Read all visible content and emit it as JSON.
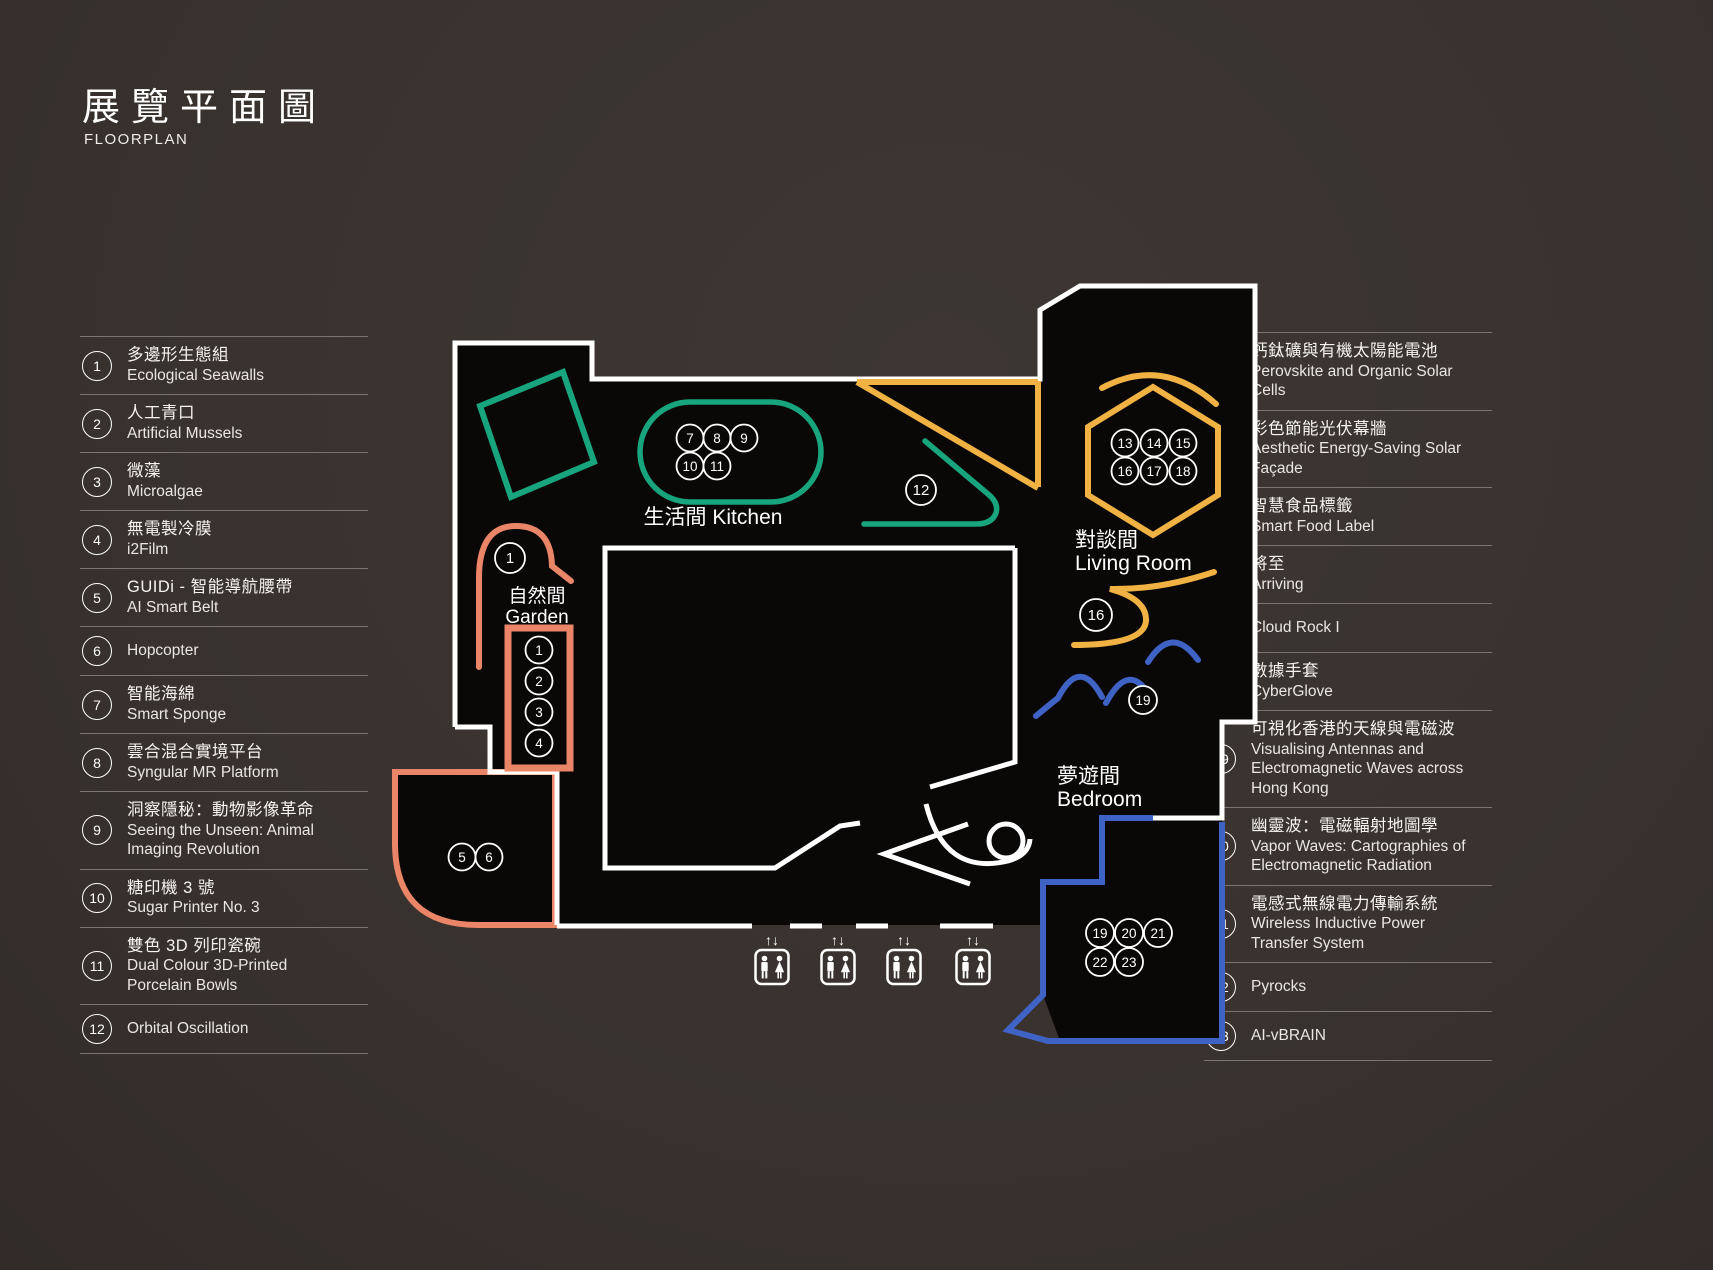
{
  "title": {
    "zh": "展覽平面圖",
    "en": "FLOORPLAN"
  },
  "legend_left": [
    {
      "num": "1",
      "zh": "多邊形生態組",
      "en": "Ecological Seawalls"
    },
    {
      "num": "2",
      "zh": "人工青口",
      "en": "Artificial Mussels"
    },
    {
      "num": "3",
      "zh": "微藻",
      "en": "Microalgae"
    },
    {
      "num": "4",
      "zh": "無電製冷膜",
      "en": "i2Film"
    },
    {
      "num": "5",
      "zh": "GUIDi - 智能導航腰帶",
      "en": "AI Smart Belt"
    },
    {
      "num": "6",
      "zh": "",
      "en": "Hopcopter"
    },
    {
      "num": "7",
      "zh": "智能海綿",
      "en": "Smart Sponge"
    },
    {
      "num": "8",
      "zh": "雲合混合實境平台",
      "en": "Syngular MR Platform"
    },
    {
      "num": "9",
      "zh": "洞察隱秘：動物影像革命",
      "en": "Seeing the Unseen: Animal Imaging Revolution"
    },
    {
      "num": "10",
      "zh": "糖印機 3 號",
      "en": "Sugar Printer No. 3"
    },
    {
      "num": "11",
      "zh": "雙色 3D 列印瓷碗",
      "en": "Dual Colour 3D-Printed Porcelain Bowls"
    },
    {
      "num": "12",
      "zh": "",
      "en": "Orbital Oscillation"
    }
  ],
  "legend_right": [
    {
      "num": "13",
      "zh": "鈣鈦礦與有機太陽能電池",
      "en": "Perovskite and Organic Solar Cells"
    },
    {
      "num": "14",
      "zh": "彩色節能光伏幕牆",
      "en": "Aesthetic Energy-Saving Solar Façade"
    },
    {
      "num": "15",
      "zh": "智慧食品標籤",
      "en": "Smart Food Label"
    },
    {
      "num": "16",
      "zh": "將至",
      "en": "Arriving"
    },
    {
      "num": "17",
      "zh": "",
      "en": "Cloud Rock I"
    },
    {
      "num": "18",
      "zh": "數據手套",
      "en": "CyberGlove"
    },
    {
      "num": "19",
      "zh": "可視化香港的天線與電磁波",
      "en": "Visualising Antennas and Electromagnetic Waves across Hong Kong"
    },
    {
      "num": "20",
      "zh": "幽靈波：電磁輻射地圖學",
      "en": "Vapor Waves: Cartographies of Electromagnetic Radiation"
    },
    {
      "num": "21",
      "zh": "電感式無線電力傳輸系統",
      "en": "Wireless Inductive Power Transfer System"
    },
    {
      "num": "22",
      "zh": "",
      "en": "Pyrocks"
    },
    {
      "num": "23",
      "zh": "",
      "en": "AI-vBRAIN"
    }
  ],
  "map": {
    "colors": {
      "teal": "#18a57e",
      "yellow": "#f0b243",
      "orange": "#ea8568",
      "blue": "#3f63c5",
      "wall": "#ffffff",
      "floor": "#0a0807"
    },
    "rooms": [
      {
        "id": "kitchen",
        "zh": "生活間",
        "en": "Kitchen",
        "x": 713,
        "y": 524,
        "anchor": "middle",
        "inline": true,
        "size": 21
      },
      {
        "id": "garden",
        "zh": "自然間",
        "en": "Garden",
        "x": 537,
        "y": 602,
        "anchor": "middle",
        "inline": false,
        "size": 19
      },
      {
        "id": "living-room",
        "zh": "對談間",
        "en": "Living Room",
        "x": 1075,
        "y": 547,
        "anchor": "start",
        "inline": false,
        "size": 21
      },
      {
        "id": "bedroom",
        "zh": "夢遊間",
        "en": "Bedroom",
        "x": 1057,
        "y": 783,
        "anchor": "start",
        "inline": false,
        "size": 21
      }
    ],
    "markers": [
      {
        "n": "1",
        "x": 510,
        "y": 558,
        "r": 15
      },
      {
        "n": "1",
        "x": 539,
        "y": 650,
        "r": 13.5
      },
      {
        "n": "2",
        "x": 539,
        "y": 681,
        "r": 13.5
      },
      {
        "n": "3",
        "x": 539,
        "y": 712,
        "r": 13.5
      },
      {
        "n": "4",
        "x": 539,
        "y": 743,
        "r": 13.5
      },
      {
        "n": "5",
        "x": 462,
        "y": 857,
        "r": 13.5
      },
      {
        "n": "6",
        "x": 489,
        "y": 857,
        "r": 13.5
      },
      {
        "n": "7",
        "x": 690,
        "y": 438,
        "r": 13.5
      },
      {
        "n": "8",
        "x": 717,
        "y": 438,
        "r": 13.5
      },
      {
        "n": "9",
        "x": 744,
        "y": 438,
        "r": 13.5
      },
      {
        "n": "10",
        "x": 690,
        "y": 466,
        "r": 13.5
      },
      {
        "n": "11",
        "x": 717,
        "y": 466,
        "r": 13.5
      },
      {
        "n": "12",
        "x": 921,
        "y": 490,
        "r": 15
      },
      {
        "n": "13",
        "x": 1125,
        "y": 443,
        "r": 13.5
      },
      {
        "n": "14",
        "x": 1154,
        "y": 443,
        "r": 13.5
      },
      {
        "n": "15",
        "x": 1183,
        "y": 443,
        "r": 13.5
      },
      {
        "n": "16",
        "x": 1125,
        "y": 471,
        "r": 13.5
      },
      {
        "n": "17",
        "x": 1154,
        "y": 471,
        "r": 13.5
      },
      {
        "n": "18",
        "x": 1183,
        "y": 471,
        "r": 13.5
      },
      {
        "n": "16",
        "x": 1096,
        "y": 615,
        "r": 16
      },
      {
        "n": "19",
        "x": 1143,
        "y": 700,
        "r": 14
      },
      {
        "n": "19",
        "x": 1100,
        "y": 933,
        "r": 14
      },
      {
        "n": "20",
        "x": 1129,
        "y": 933,
        "r": 14
      },
      {
        "n": "21",
        "x": 1158,
        "y": 933,
        "r": 14
      },
      {
        "n": "22",
        "x": 1100,
        "y": 962,
        "r": 14
      },
      {
        "n": "23",
        "x": 1129,
        "y": 962,
        "r": 14
      }
    ],
    "elevators": {
      "xs": [
        772,
        838,
        904,
        973
      ],
      "arrows": "↑↓"
    }
  }
}
